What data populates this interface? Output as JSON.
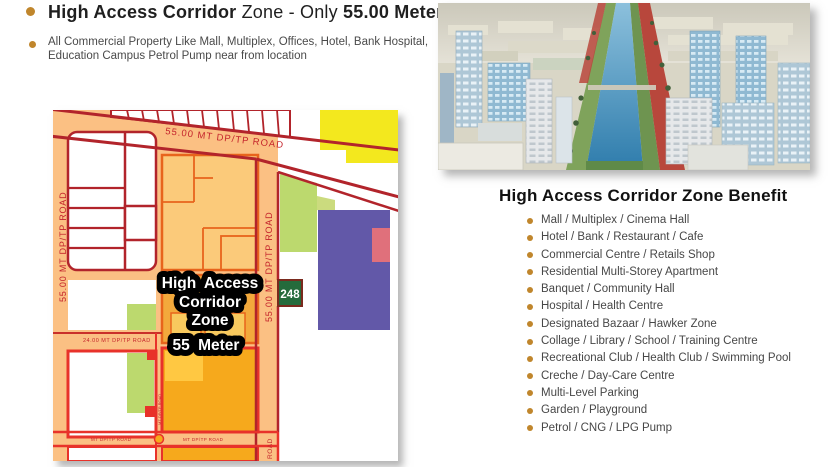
{
  "colors": {
    "accent_gold": "#C0862C",
    "title_text": "#1F1F1F",
    "body_text": "#4A4A4A",
    "map_bg": "#FBC083",
    "road_border_dark": "#B2242B",
    "road_border_bright": "#E8322A",
    "zone_light": "#FBCA7A",
    "zone_mid": "#F3A93C",
    "zone_deep": "#F6A91C",
    "zone_border": "#E8641C",
    "parcel_yellow": "#F3E81E",
    "parcel_green": "#BCD96E",
    "parcel_purple": "#6258A8",
    "parcel_salmon": "#E0707B",
    "sign_green": "#256B3C"
  },
  "header": {
    "title": {
      "bold1": "High Access Corridor",
      "mid": " Zone - Only ",
      "bold2": "55.00 Meter"
    },
    "description_line1": "All Commercial Property Like Mall, Multiplex, Offices, Hotel, Bank Hospital,",
    "description_line2": "Education Campus Petrol Pump near from location"
  },
  "map": {
    "roads": {
      "top_label": "55.00 MT DP/TP ROAD",
      "left_label": "55.00 MT DP/TP ROAD",
      "center_label": "55.00 MT DP/TP ROAD",
      "cross_label": "24.00 MT DP/TP ROAD",
      "bottom_label_left": "MT DP/TP ROAD",
      "bottom_label_right": "MT DP/TP ROAD",
      "gap_label": "MT DP/TP ROAD",
      "vert_tail_label": "ROAD"
    },
    "zone_label": {
      "line1": "High Access",
      "line2": "Corridor",
      "line3": "Zone"
    },
    "meter_label": "55 Meter",
    "route_sign": "248"
  },
  "benefits": {
    "heading": "High Access Corridor Zone Benefit",
    "items": [
      "Mall / Multiplex / Cinema Hall",
      "Hotel / Bank / Restaurant / Cafe",
      "Commercial Centre / Retails Shop",
      "Residential Multi-Storey Apartment",
      "Banquet / Community Hall",
      "Hospital / Health Centre",
      "Designated Bazaar / Hawker Zone",
      "Collage / Library / School / Training Centre",
      "Recreational Club / Health Club / Swimming Pool",
      "Creche / Day-Care Centre",
      "Multi-Level Parking",
      "Garden / Playground",
      "Petrol / CNG / LPG Pump"
    ]
  }
}
